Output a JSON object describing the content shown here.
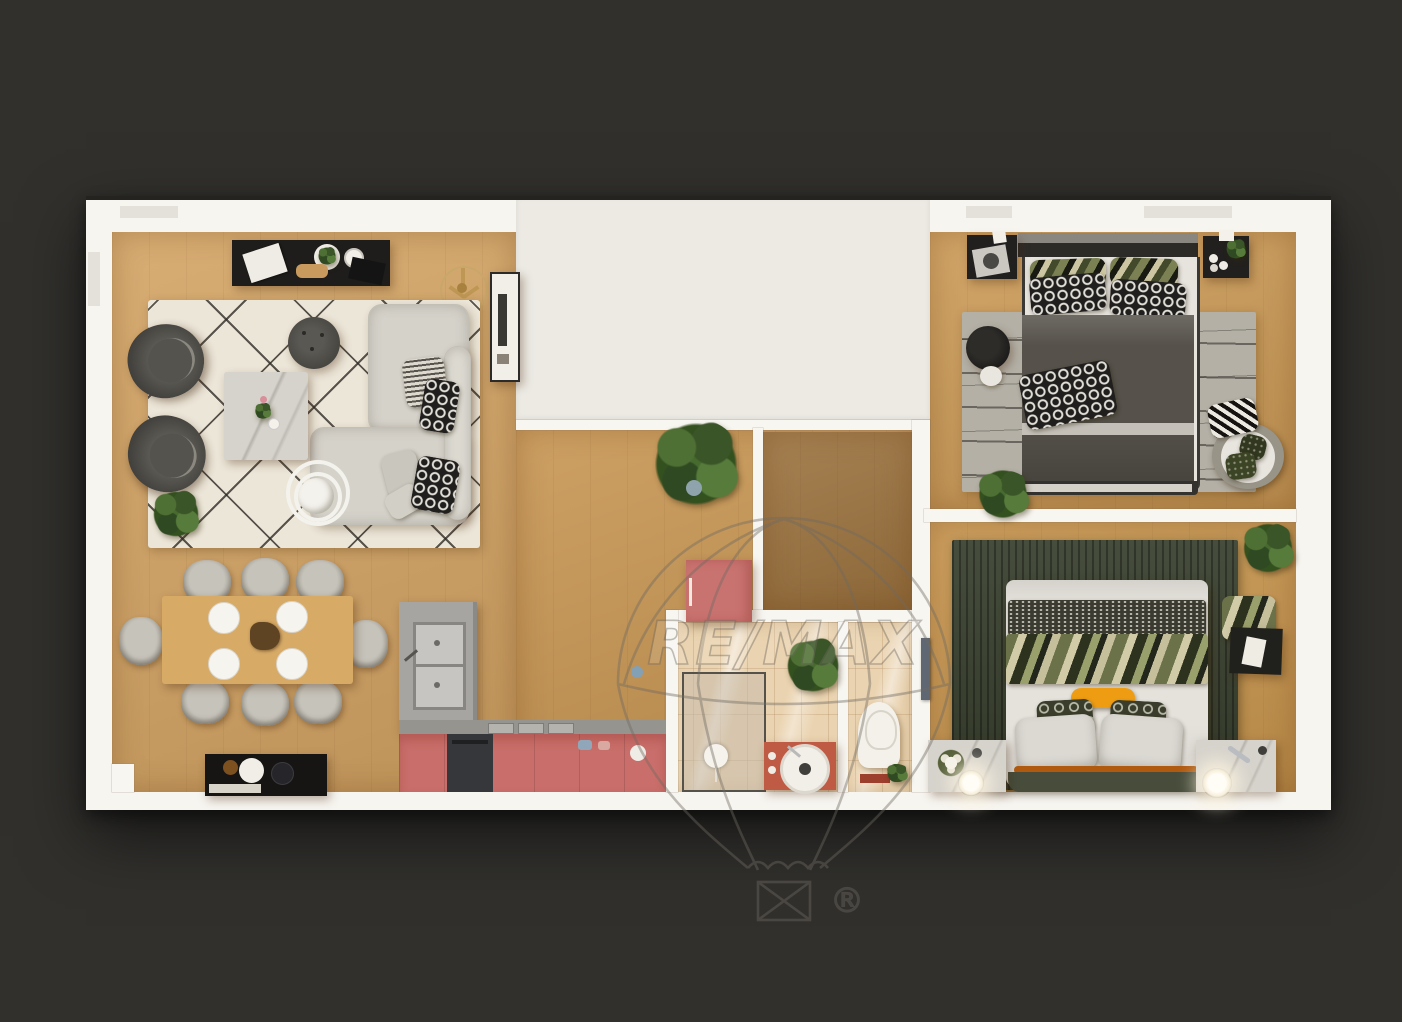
{
  "image": {
    "kind": "3d-floor-plan-top-view-render"
  },
  "watermark": {
    "brand": "RE/MAX",
    "registered": "®",
    "color": "#6f6a62"
  },
  "palette": {
    "background": "#31302d",
    "wall": "#f7f5f0",
    "cutout": "#eceae3",
    "wood_living": "#d3a464",
    "wood_corridor": "#c79552",
    "wood_hall": "#9c733f",
    "wood_bedroom1": "#cc9b57",
    "wood_bedroom2": "#c9974f",
    "tile_bathroom": "#ead3b0",
    "rug_cream": "#ece6d8",
    "rug_gray": "#b4b0a6",
    "rug_green": "#3b4230",
    "sofa_gray": "#d5d2ca",
    "armchair_dark": "#44423e",
    "kitchen_cabinet_pink": "#c96e6a",
    "island_concrete": "#a6a5a1",
    "vanity_terracotta": "#bf5a45",
    "wardrobe_pink": "#c97370",
    "bed1_duvet": "#56524b",
    "bed2_duvet": "#e5e2dc",
    "accent_orange": "#ee9d13",
    "nightstand_black": "#21201e",
    "nightstand_marble": "#d6d3cc"
  },
  "rooms": [
    {
      "name": "living-room"
    },
    {
      "name": "dining-area"
    },
    {
      "name": "kitchen"
    },
    {
      "name": "corridor"
    },
    {
      "name": "entry-hall"
    },
    {
      "name": "bathroom"
    },
    {
      "name": "wc"
    },
    {
      "name": "bedroom-1"
    },
    {
      "name": "bedroom-2"
    }
  ]
}
